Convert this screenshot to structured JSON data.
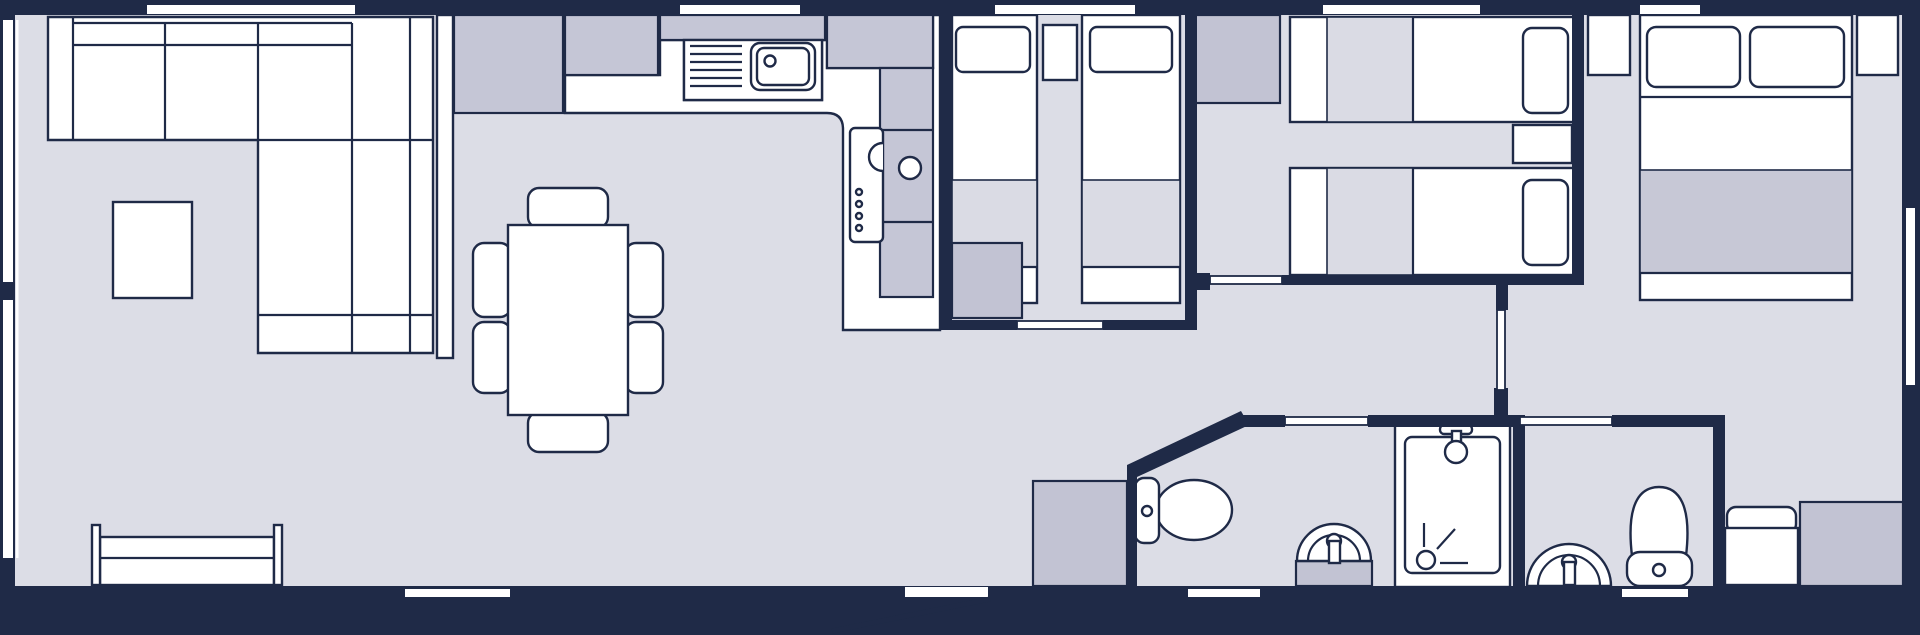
{
  "title": "static-caravan-holiday-lodge-floor-plan",
  "colors": {
    "background": "#1f2a47",
    "wall": "#1f2a47",
    "floor": "#dcdde6",
    "furniture": "#ffffff",
    "counter": "#c5c6d6",
    "cabinet": "#c2c3d3",
    "blanket_light": "#dadbe4",
    "blanket_dark": "#c7c8d6"
  },
  "floor_plan": {
    "rooms": [
      {
        "name": "living-area",
        "items": [
          "corner-sofa",
          "coffee-table",
          "tv-bench",
          "side-windows"
        ]
      },
      {
        "name": "dining-area",
        "items": [
          "dining-table",
          "six-chairs"
        ]
      },
      {
        "name": "kitchen",
        "items": [
          "worktops",
          "sink-with-drainer",
          "cooker-with-knobs",
          "hob-burner",
          "tall-unit",
          "divider-partition"
        ]
      },
      {
        "name": "twin-bedroom-1",
        "items": [
          "single-bed",
          "single-bed",
          "bedside-table",
          "wardrobe",
          "sliding-door"
        ]
      },
      {
        "name": "twin-bedroom-2",
        "items": [
          "single-bed",
          "single-bed",
          "bedside-table",
          "wardrobe",
          "sliding-door"
        ]
      },
      {
        "name": "master-bedroom",
        "items": [
          "double-bed",
          "two-pillows",
          "bedside-table-left",
          "bedside-table-right",
          "ottoman-bench",
          "wardrobe",
          "door"
        ]
      },
      {
        "name": "shower-room",
        "items": [
          "toilet",
          "pedestal-basin",
          "shower-enclosure",
          "angled-wall",
          "sliding-door"
        ]
      },
      {
        "name": "en-suite",
        "items": [
          "toilet",
          "pedestal-basin",
          "sliding-door"
        ]
      },
      {
        "name": "hallway",
        "items": [
          "storage-unit",
          "entrance-door-open"
        ]
      }
    ],
    "openings": {
      "top_wall_windows": 5,
      "bottom_wall_windows": 3,
      "left_wall_windows": 2,
      "right_wall_windows": 1,
      "entrance_doors": 1
    }
  }
}
